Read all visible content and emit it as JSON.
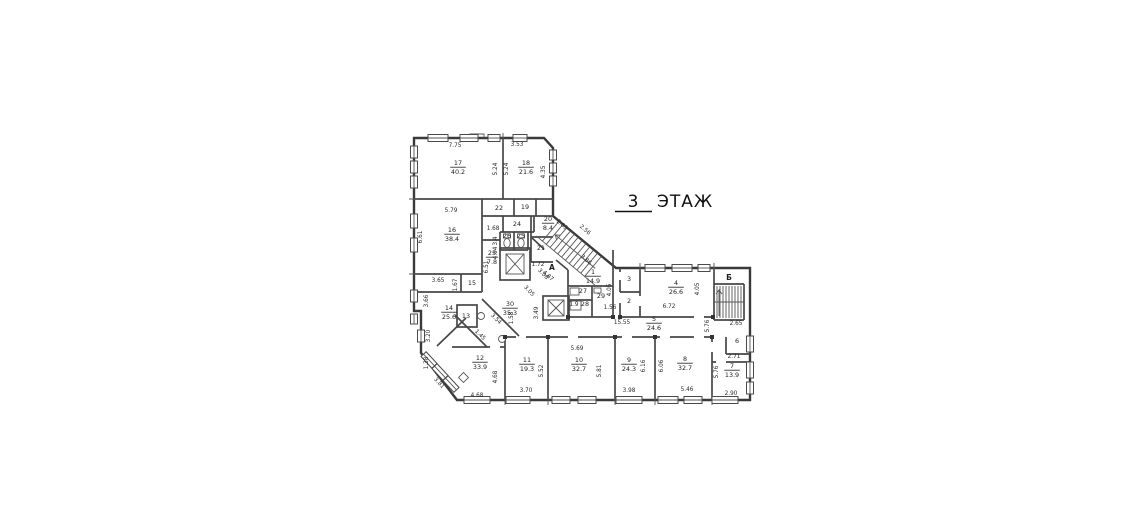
{
  "title": {
    "floor_number": "3",
    "floor_word": "ЭТАЖ"
  },
  "stair_letters": [
    {
      "t": "А",
      "x": 552,
      "y": 270
    },
    {
      "t": "Б",
      "x": 729,
      "y": 280
    }
  ],
  "rooms": [
    {
      "n": "17",
      "a": "40.2",
      "x": 458,
      "y": 165
    },
    {
      "n": "18",
      "a": "21.6",
      "x": 526,
      "y": 165
    },
    {
      "n": "16",
      "a": "38.4",
      "x": 452,
      "y": 232
    },
    {
      "n": "22",
      "a": "",
      "x": 499,
      "y": 210
    },
    {
      "n": "19",
      "a": "",
      "x": 525,
      "y": 209
    },
    {
      "n": "24",
      "a": "",
      "x": 517,
      "y": 226
    },
    {
      "n": "26",
      "a": "",
      "x": 507,
      "y": 238
    },
    {
      "n": "25",
      "a": "",
      "x": 521,
      "y": 238
    },
    {
      "n": "20",
      "a": "8.4",
      "x": 548,
      "y": 221
    },
    {
      "n": "21",
      "a": "",
      "x": 541,
      "y": 250
    },
    {
      "n": "23",
      "a": "7.8",
      "x": 492,
      "y": 255
    },
    {
      "n": "15",
      "a": "",
      "x": 472,
      "y": 285
    },
    {
      "n": "14",
      "a": "25.6",
      "x": 449,
      "y": 310
    },
    {
      "n": "13",
      "a": "",
      "x": 466,
      "y": 318
    },
    {
      "n": "30",
      "a": "35.3",
      "x": 510,
      "y": 306
    },
    {
      "n": "12",
      "a": "33.9",
      "x": 480,
      "y": 360
    },
    {
      "n": "11",
      "a": "19.3",
      "x": 527,
      "y": 362
    },
    {
      "n": "10",
      "a": "32.7",
      "x": 579,
      "y": 362
    },
    {
      "n": "9",
      "a": "24.3",
      "x": 629,
      "y": 362
    },
    {
      "n": "8",
      "a": "32.7",
      "x": 685,
      "y": 361
    },
    {
      "n": "7",
      "a": "13.9",
      "x": 732,
      "y": 368
    },
    {
      "n": "6",
      "a": "",
      "x": 737,
      "y": 343
    },
    {
      "n": "5",
      "a": "24.6",
      "x": 654,
      "y": 321
    },
    {
      "n": "4",
      "a": "26.6",
      "x": 676,
      "y": 285
    },
    {
      "n": "3",
      "a": "",
      "x": 629,
      "y": 281
    },
    {
      "n": "2",
      "a": "",
      "x": 629,
      "y": 303
    },
    {
      "n": "1",
      "a": "14.9",
      "x": 593,
      "y": 274
    },
    {
      "n": "27",
      "a": "",
      "x": 583,
      "y": 293
    },
    {
      "n": "28",
      "a": "",
      "x": 585,
      "y": 306
    },
    {
      "n": "29",
      "a": "",
      "x": 601,
      "y": 298
    }
  ],
  "dims": [
    {
      "t": "7.75",
      "x": 455,
      "y": 147,
      "r": 0
    },
    {
      "t": "3.53",
      "x": 517,
      "y": 146,
      "r": 0
    },
    {
      "t": "5.24",
      "x": 497,
      "y": 169,
      "r": -90
    },
    {
      "t": "5.24",
      "x": 508,
      "y": 169,
      "r": -90
    },
    {
      "t": "4.35",
      "x": 545,
      "y": 172,
      "r": -90
    },
    {
      "t": "5.79",
      "x": 451,
      "y": 212,
      "r": 0
    },
    {
      "t": "6.61",
      "x": 422,
      "y": 237,
      "r": -90
    },
    {
      "t": "1.68",
      "x": 493,
      "y": 230,
      "r": 0
    },
    {
      "t": "3.4",
      "x": 497,
      "y": 241,
      "r": -90
    },
    {
      "t": "4.04",
      "x": 497,
      "y": 253,
      "r": -90
    },
    {
      "t": "2.63",
      "x": 561,
      "y": 226,
      "r": 41
    },
    {
      "t": "1.72",
      "x": 538,
      "y": 266,
      "r": 0
    },
    {
      "t": "4.87",
      "x": 547,
      "y": 277,
      "r": 41
    },
    {
      "t": "2.56",
      "x": 584,
      "y": 231,
      "r": 41
    },
    {
      "t": "3.86",
      "x": 585,
      "y": 261,
      "r": 41
    },
    {
      "t": "6.51",
      "x": 488,
      "y": 267,
      "r": -90
    },
    {
      "t": "3.08",
      "x": 542,
      "y": 275,
      "r": 47
    },
    {
      "t": "3.05",
      "x": 528,
      "y": 292,
      "r": 47
    },
    {
      "t": "3.49",
      "x": 538,
      "y": 313,
      "r": -90
    },
    {
      "t": "1.58",
      "x": 513,
      "y": 318,
      "r": -90
    },
    {
      "t": "3.65",
      "x": 438,
      "y": 282,
      "r": 0
    },
    {
      "t": "1.67",
      "x": 457,
      "y": 285,
      "r": -90
    },
    {
      "t": "3.66",
      "x": 428,
      "y": 301,
      "r": -90
    },
    {
      "t": "3.20",
      "x": 430,
      "y": 336,
      "r": -90
    },
    {
      "t": "1.38",
      "x": 428,
      "y": 363,
      "r": -90
    },
    {
      "t": "3.81",
      "x": 438,
      "y": 384,
      "r": 47
    },
    {
      "t": "3.54",
      "x": 495,
      "y": 320,
      "r": 45
    },
    {
      "t": "1.45",
      "x": 479,
      "y": 336,
      "r": 45
    },
    {
      "t": "4.68",
      "x": 497,
      "y": 377,
      "r": -90
    },
    {
      "t": "4.68",
      "x": 477,
      "y": 397,
      "r": 0
    },
    {
      "t": "3.70",
      "x": 526,
      "y": 392,
      "r": 0
    },
    {
      "t": "5.52",
      "x": 543,
      "y": 371,
      "r": -90
    },
    {
      "t": "5.69",
      "x": 577,
      "y": 350,
      "r": 0
    },
    {
      "t": "5.81",
      "x": 601,
      "y": 371,
      "r": -90
    },
    {
      "t": "3.98",
      "x": 629,
      "y": 392,
      "r": 0
    },
    {
      "t": "6.16",
      "x": 645,
      "y": 366,
      "r": -90
    },
    {
      "t": "6.06",
      "x": 663,
      "y": 366,
      "r": -90
    },
    {
      "t": "5.46",
      "x": 687,
      "y": 391,
      "r": 0
    },
    {
      "t": "5.76",
      "x": 718,
      "y": 372,
      "r": -90
    },
    {
      "t": "2.90",
      "x": 731,
      "y": 395,
      "r": 0
    },
    {
      "t": "2.71",
      "x": 734,
      "y": 358,
      "r": 0
    },
    {
      "t": "2.65",
      "x": 736,
      "y": 325,
      "r": 0
    },
    {
      "t": "5.76",
      "x": 709,
      "y": 326,
      "r": -90
    },
    {
      "t": "15.55",
      "x": 622,
      "y": 324,
      "r": 0
    },
    {
      "t": "6.72",
      "x": 669,
      "y": 308,
      "r": 0
    },
    {
      "t": "4.05",
      "x": 699,
      "y": 289,
      "r": -90
    },
    {
      "t": "4.05",
      "x": 611,
      "y": 290,
      "r": -90
    },
    {
      "t": "1.56",
      "x": 610,
      "y": 309,
      "r": 0
    },
    {
      "t": "1.9",
      "x": 574,
      "y": 306,
      "r": 0
    }
  ]
}
